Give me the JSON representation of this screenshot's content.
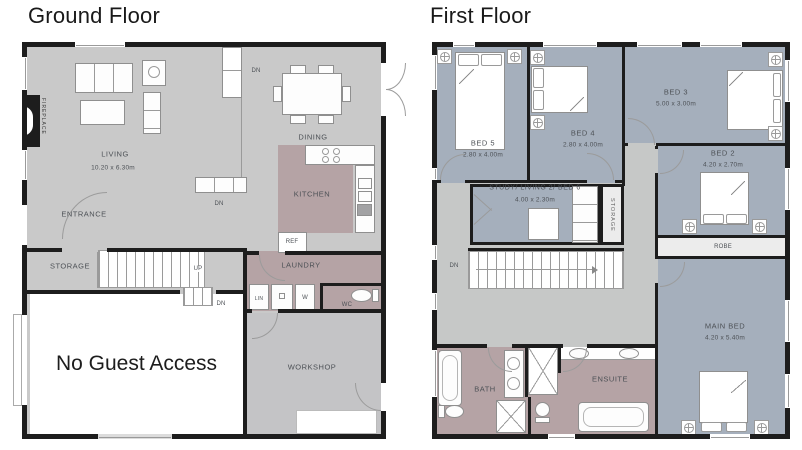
{
  "titles": {
    "ground": "Ground Floor",
    "first": "First Floor"
  },
  "colors": {
    "wall": "#1d1d1d",
    "floor_gray": "#c9c9c9",
    "floor_mauve": "#b5a3a5",
    "floor_blue": "#a5afbc",
    "landing_gray": "#c6c8c7",
    "workshop_gray": "#c4c4c6",
    "strip_light": "#ececec",
    "label": "#4d5156"
  },
  "ground_floor": {
    "living": {
      "name": "LIVING",
      "dims": "10.20 x 6.30m"
    },
    "dining": {
      "name": "DINING"
    },
    "kitchen": {
      "name": "KITCHEN"
    },
    "entrance": {
      "name": "ENTRANCE"
    },
    "storage": {
      "name": "STORAGE"
    },
    "laundry": {
      "name": "LAUNDRY"
    },
    "workshop": {
      "name": "WORKSHOP"
    },
    "garage_note": "No Guest Access",
    "fireplace": "FIREPLACE",
    "ref": "REF",
    "lin": "LIN",
    "washer": "W",
    "wc": "WC",
    "up": "UP",
    "dn": "DN"
  },
  "first_floor": {
    "bed5": {
      "name": "BED 5",
      "dims": "2.80 x 4.00m"
    },
    "bed4": {
      "name": "BED 4",
      "dims": "2.80 x 4.00m"
    },
    "bed3": {
      "name": "BED 3",
      "dims": "5.00 x 3.00m"
    },
    "bed2": {
      "name": "BED 2",
      "dims": "4.20 x 2.70m"
    },
    "main_bed": {
      "name": "MAIN BED",
      "dims": "4.20 x 5.40m"
    },
    "study": {
      "name": "STUDY/ LIVING 2/ BED 6",
      "dims": "4.00 x 2.30m"
    },
    "robe": "ROBE",
    "storage": "STORAGE",
    "bath": "BATH",
    "ensuite": "ENSUITE",
    "dn": "DN"
  }
}
